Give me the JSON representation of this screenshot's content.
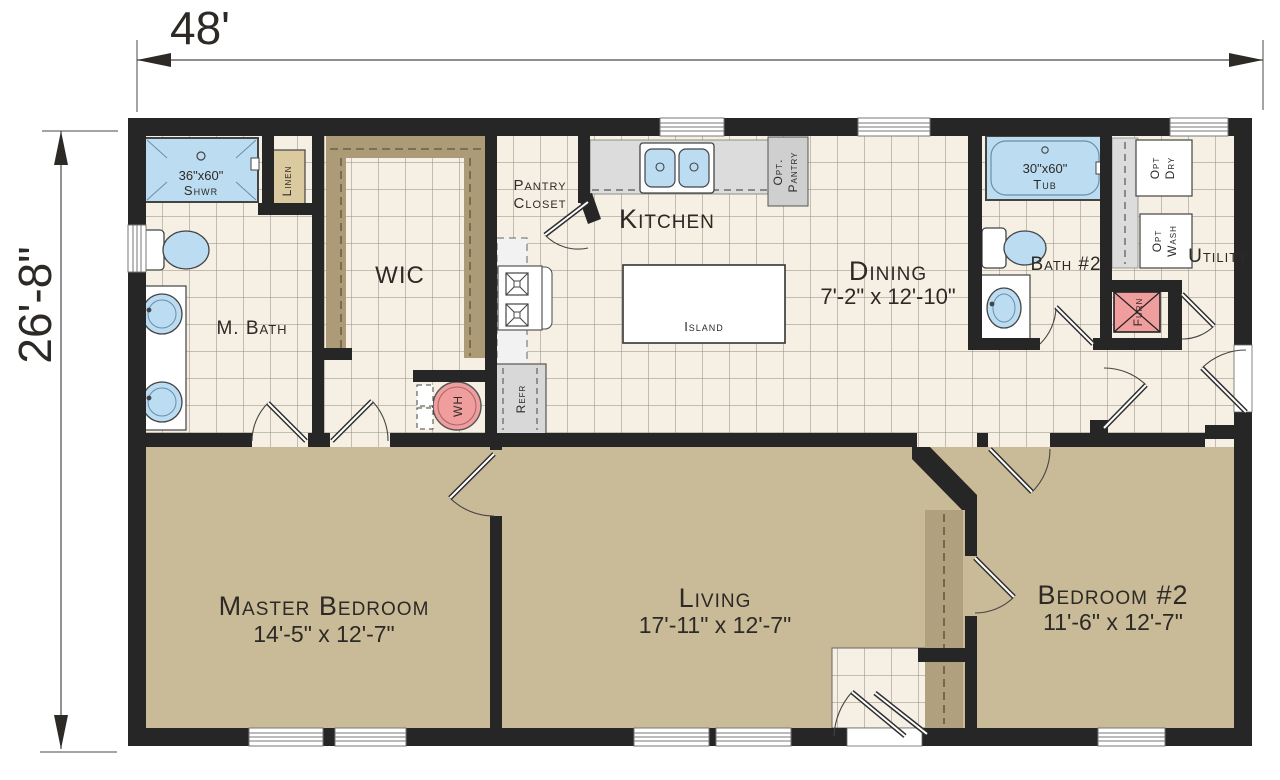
{
  "plan": {
    "title": "floor-plan",
    "dimensions": {
      "width": "48'",
      "depth": "26'-8\""
    }
  },
  "rooms": {
    "master_bath": {
      "label": "M. Bath"
    },
    "wic": {
      "label": "WIC"
    },
    "pantry_closet": {
      "label_line1": "Pantry",
      "label_line2": "Closet"
    },
    "kitchen": {
      "label": "Kitchen"
    },
    "dining": {
      "label": "Dining",
      "size": "7'-2\" x 12'-10\""
    },
    "bath2": {
      "label": "Bath #2"
    },
    "utility": {
      "label": "Utility"
    },
    "master_bedroom": {
      "label": "Master Bedroom",
      "size": "14'-5\" x 12'-7\""
    },
    "living": {
      "label": "Living",
      "size": "17'-11\" x 12'-7\""
    },
    "bedroom2": {
      "label": "Bedroom #2",
      "size": "11'-6\" x 12'-7\""
    }
  },
  "fixtures": {
    "shower": {
      "size": "36\"x60\"",
      "label": "Shwr"
    },
    "tub": {
      "size": "30\"x60\"",
      "label": "Tub"
    },
    "linen": {
      "label": "Linen"
    },
    "island": {
      "label": "Island"
    },
    "refrigerator": {
      "label": "Refr"
    },
    "water_heater": {
      "label": "WH"
    },
    "furnace": {
      "label": "Furn"
    },
    "opt_pantry": {
      "label_line1": "Opt.",
      "label_line2": "Pantry"
    },
    "opt_dryer": {
      "label_line1": "Opt",
      "label_line2": "Dry"
    },
    "opt_washer": {
      "label_line1": "Opt",
      "label_line2": "Wash"
    }
  },
  "colors": {
    "wall": "#262626",
    "tile_floor": "#f5f0e3",
    "tile_grid": "#8f8a7e",
    "carpet": "#c9ba98",
    "fixture_blue": "#bcdcf2",
    "equipment_pink": "#f09d9d",
    "shelf_tan": "#ac9b76",
    "closet_tan": "#dbcaa0",
    "counter_gray": "#dcdcdc"
  }
}
